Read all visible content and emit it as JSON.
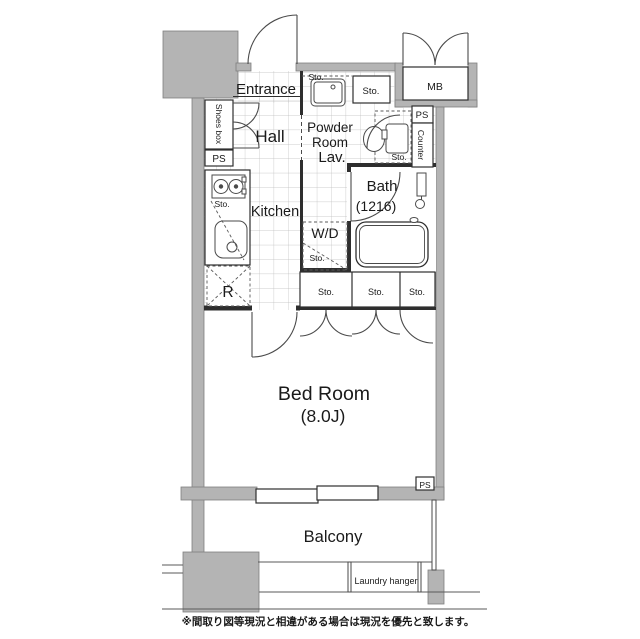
{
  "floorplan": {
    "unit": {
      "entrance_label": "Entrance",
      "hall_label": "Hall",
      "shoes_box_label": "Shoes box",
      "kitchen_label": "Kitchen",
      "refrigerator_label": "R",
      "powder_room_label_line1": "Powder",
      "powder_room_label_line2": "Room",
      "lavatory_label": "Lav.",
      "bath_label": "Bath",
      "bath_size_label": "(1216)",
      "washer_dryer_label": "W/D",
      "bedroom_label": "Bed Room",
      "bedroom_size_label": "(8.0J)",
      "balcony_label": "Balcony",
      "laundry_hanger_label": "Laundry hanger",
      "meter_box_label": "MB",
      "counter_label": "Counter",
      "pipe_space_label": "PS",
      "storage_label": "Sto."
    },
    "disclaimer": "※間取り図等現況と相違がある場合は現況を優先と致します。",
    "colors": {
      "wall_gray": "#b4b4b4",
      "wall_outline": "#7f7f7f",
      "interior_line": "#2e2e2e",
      "tile_grid": "#bdbdbd",
      "text": "#1a1a1a",
      "background": "#ffffff"
    }
  }
}
